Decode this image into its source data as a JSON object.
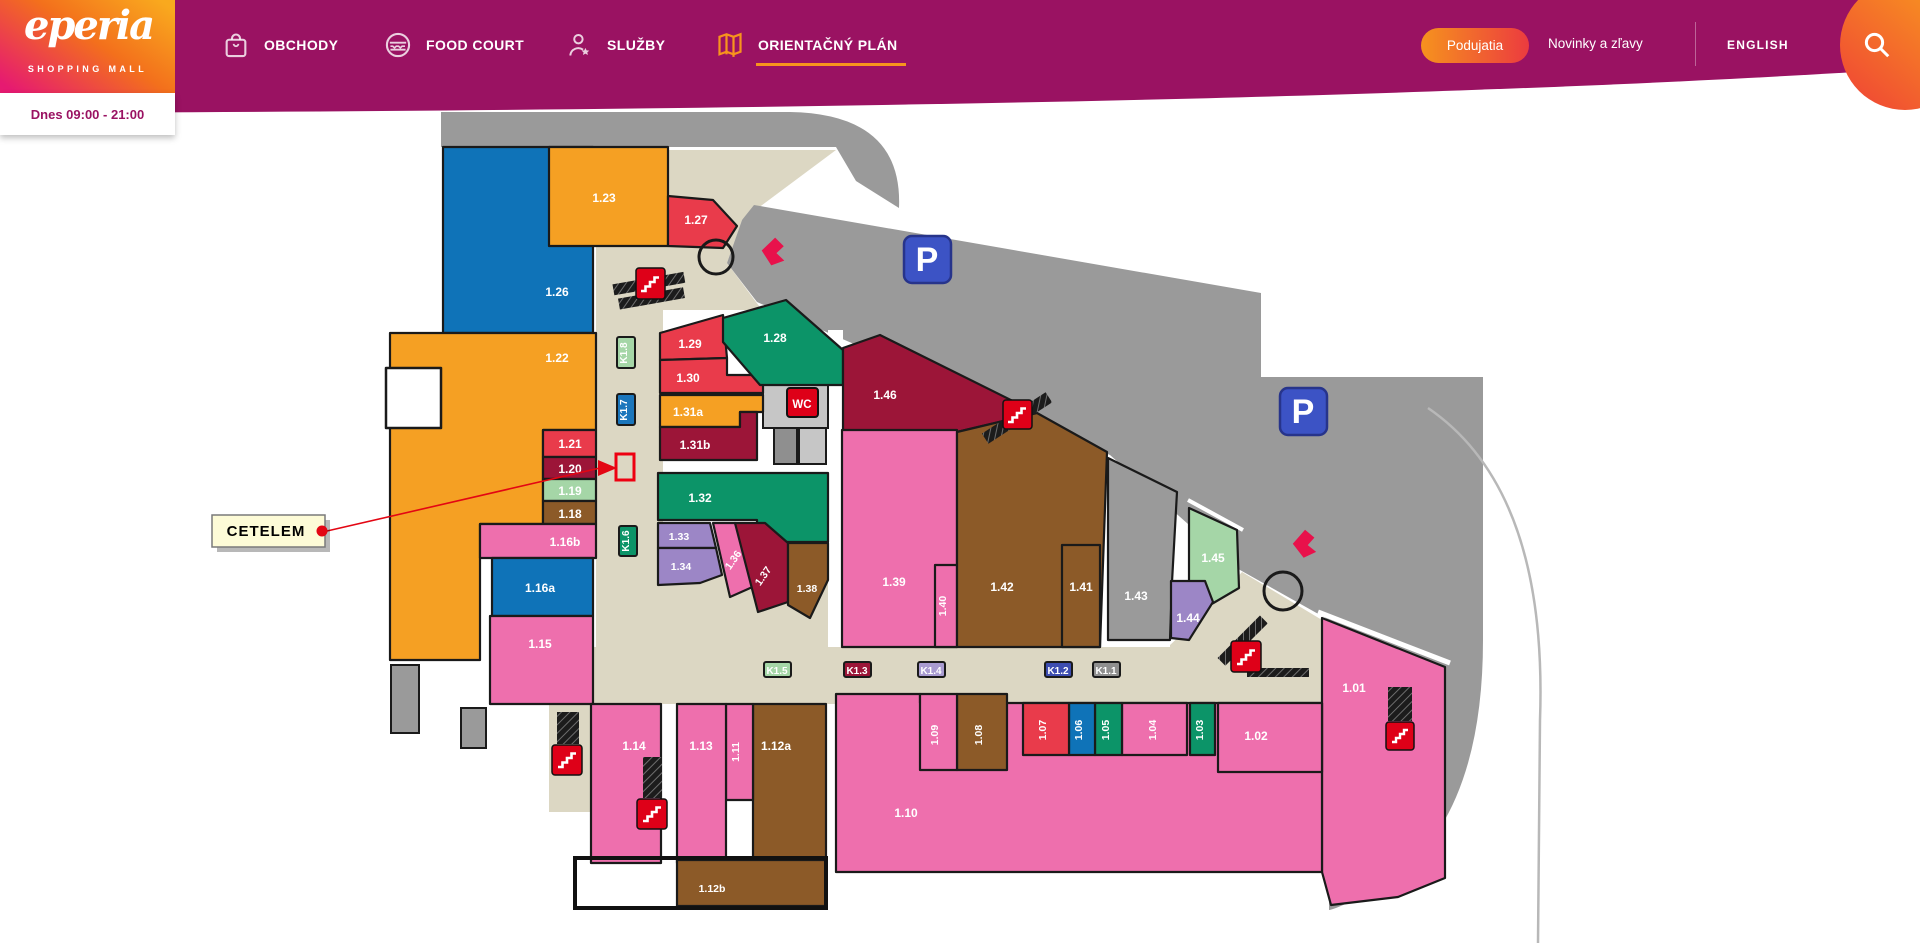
{
  "header": {
    "logo": {
      "name": "eperia",
      "tagline": "SHOPPING MALL"
    },
    "nav": [
      {
        "label": "OBCHODY",
        "icon": "shopping-bag-icon"
      },
      {
        "label": "FOOD COURT",
        "icon": "burger-icon"
      },
      {
        "label": "SLUŽBY",
        "icon": "services-person-icon"
      },
      {
        "label": "ORIENTAČNÝ PLÁN",
        "icon": "map-icon"
      }
    ],
    "active_nav": "ORIENTAČNÝ PLÁN",
    "podujatia_label": "Podujatia",
    "novinky_label": "Novinky a zľavy",
    "language_label": "ENGLISH",
    "search_icon": "search-icon"
  },
  "hours_bar": {
    "text": "Dnes 09:00 - 21:00"
  },
  "map": {
    "tooltip": {
      "label": "CETELEM"
    },
    "wc_label": "WC",
    "parking_label": "P",
    "units": {
      "u101": "1.01",
      "u102": "1.02",
      "u103": "1.03",
      "u104": "1.04",
      "u105": "1.05",
      "u106": "1.06",
      "u107": "1.07",
      "u108": "1.08",
      "u109": "1.09",
      "u110": "1.10",
      "u111": "1.11",
      "u112a": "1.12a",
      "u112b": "1.12b",
      "u113": "1.13",
      "u114": "1.14",
      "u115": "1.15",
      "u116a": "1.16a",
      "u116b": "1.16b",
      "u118": "1.18",
      "u119": "1.19",
      "u120": "1.20",
      "u121": "1.21",
      "u122": "1.22",
      "u123": "1.23",
      "u126": "1.26",
      "u127": "1.27",
      "u128": "1.28",
      "u129": "1.29",
      "u130": "1.30",
      "u131a": "1.31a",
      "u131b": "1.31b",
      "u132": "1.32",
      "u133": "1.33",
      "u134": "1.34",
      "u136": "1.36",
      "u137": "1.37",
      "u138": "1.38",
      "u139": "1.39",
      "u140": "1.40",
      "u141": "1.41",
      "u142": "1.42",
      "u143": "1.43",
      "u144": "1.44",
      "u145": "1.45",
      "u146": "1.46"
    },
    "corridors": {
      "k11": "K1.1",
      "k12": "K1.2",
      "k13": "K1.3",
      "k14": "K1.4",
      "k15": "K1.5",
      "k16": "K1.6",
      "k17": "K1.7",
      "k18": "K1.8"
    },
    "palette": {
      "pink": "#EE6FAD",
      "red": "#E93B4B",
      "crimson": "#9C1538",
      "orange": "#F5A023",
      "blue": "#0F73B8",
      "teal": "#0C9468",
      "light_green": "#A5D6A7",
      "brown": "#8C5A28",
      "purple": "#9C86C6",
      "gray_outer": "#9A9A9A",
      "walkway": "#DCD7C3",
      "header_magenta": "#9A1262",
      "accent_orange": "#F7941D",
      "stairs_red": "#DE0018",
      "parking_blue": "#3C53C5",
      "highlight_red": "#EE0011",
      "tooltip_bg": "#FDFBD7"
    }
  }
}
